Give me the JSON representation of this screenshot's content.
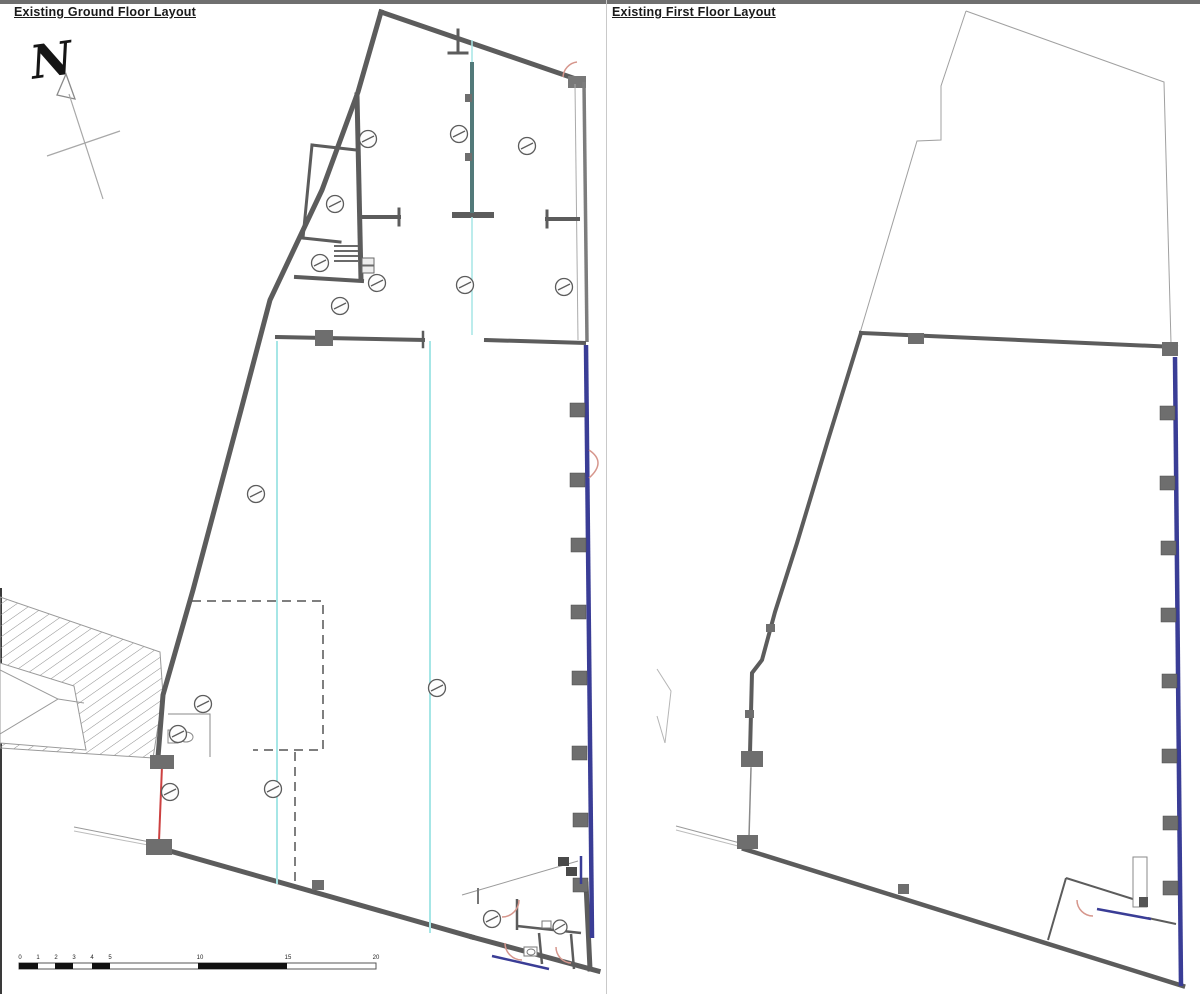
{
  "panels": {
    "ground_floor": {
      "title": "Existing Ground Floor Layout"
    },
    "first_floor": {
      "title": "Existing First Floor Layout"
    }
  },
  "north_arrow": {
    "label": "N"
  },
  "scale_bar": {
    "labels": [
      "0",
      "1",
      "2",
      "3",
      "4",
      "5",
      "10",
      "15",
      "20"
    ]
  },
  "colors": {
    "wall_gray": "#5c5c5c",
    "pier_gray": "#6e6e6e",
    "party_wall_blue": "#3a3d96",
    "setting_out_cyan": "#a6e6e6",
    "partition_teal": "#527a7a",
    "survey_red": "#cc4040",
    "door_swing_pink": "#d6968c",
    "outline_light": "#a0a0a0"
  }
}
